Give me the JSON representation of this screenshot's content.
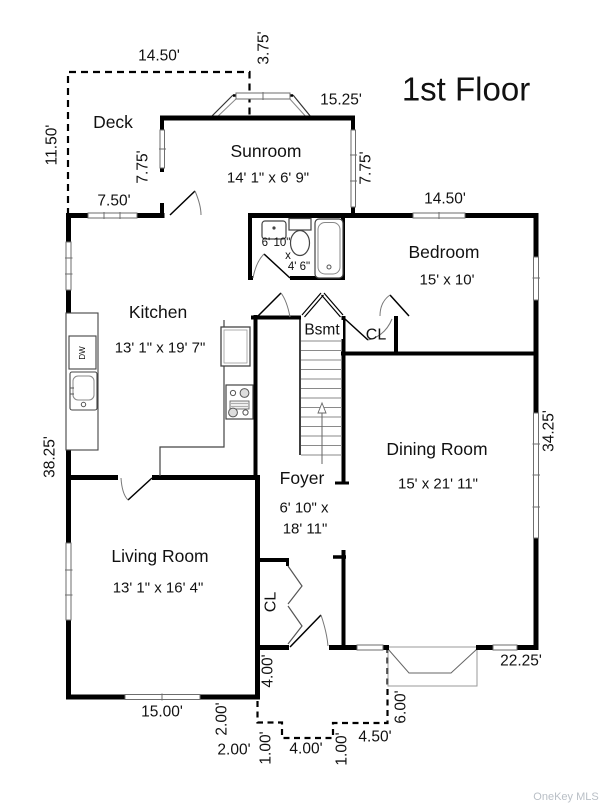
{
  "title": "1st Floor",
  "watermark": "OneKey MLS",
  "rooms": {
    "deck": {
      "name": "Deck"
    },
    "sunroom": {
      "name": "Sunroom",
      "size": "14' 1\" x 6' 9\""
    },
    "bedroom": {
      "name": "Bedroom",
      "size": "15' x 10'"
    },
    "kitchen": {
      "name": "Kitchen",
      "size": "13' 1\" x 19' 7\""
    },
    "bathroom": {
      "width": "6' 10\"",
      "sep": "x",
      "depth": "4' 6\""
    },
    "basement": {
      "name": "Bsmt"
    },
    "hall_closet": {
      "name": "CL"
    },
    "dining": {
      "name": "Dining Room",
      "size": "15' x 21' 11\""
    },
    "foyer": {
      "name": "Foyer",
      "size_line1": "6' 10\" x",
      "size_line2": "18' 11\""
    },
    "living": {
      "name": "Living Room",
      "size": "13' 1\" x 16' 4\""
    },
    "foyer_closet": {
      "name": "CL"
    }
  },
  "appliances": {
    "dishwasher": "DW"
  },
  "dimensions": {
    "deck_width": "14.50'",
    "bay_offset": "3.75'",
    "sunroom_width": "15.25'",
    "deck_depth": "11.50'",
    "sunroom_left": "7.75'",
    "deck_back": "7.50'",
    "sunroom_right": "7.75'",
    "bedroom_width": "14.50'",
    "west_side": "38.25'",
    "east_side": "34.25'",
    "living_front": "15.00'",
    "front_jog": "4.00'",
    "stoop_rise": "2.00'",
    "stoop_run": "2.00'",
    "step_left": "1.00'",
    "steps_width": "4.00'",
    "step_right": "1.00'",
    "landing": "4.50'",
    "stoop_depth": "6.00'",
    "dining_front": "22.25'"
  }
}
